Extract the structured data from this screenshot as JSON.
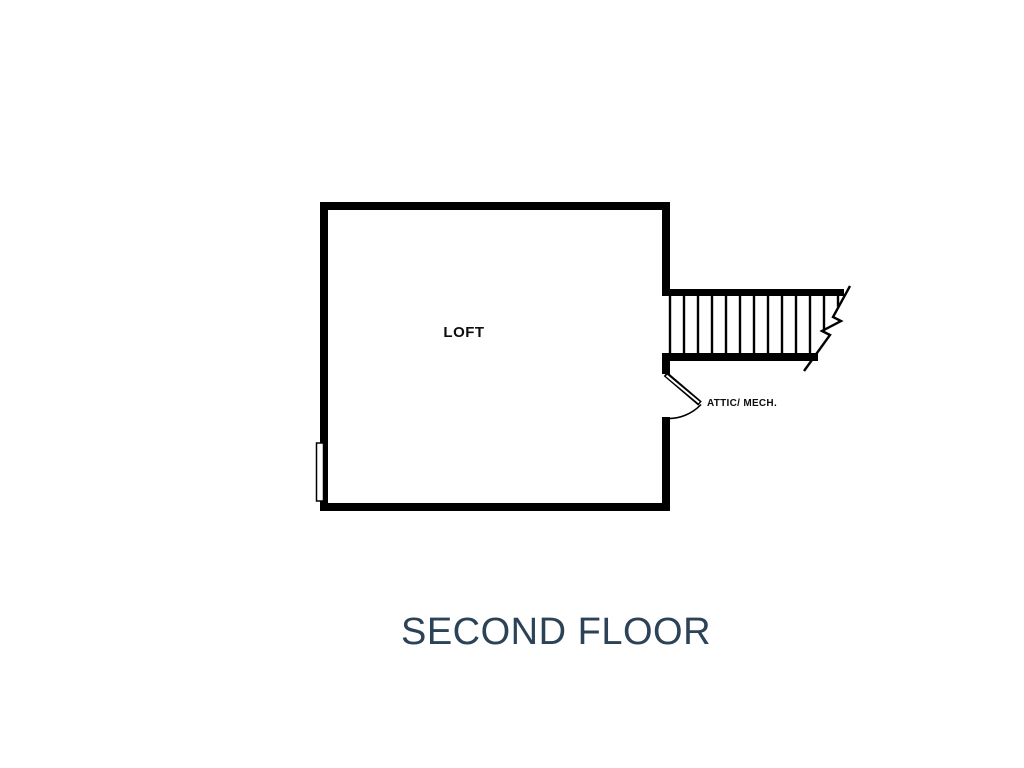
{
  "plan": {
    "title": "SECOND FLOOR",
    "rooms": [
      {
        "name": "LOFT"
      },
      {
        "name": "ATTIC/ MECH."
      }
    ],
    "stairs": {
      "tread_count": 13
    },
    "colors": {
      "wall": "#000000",
      "line": "#000000",
      "background": "#ffffff",
      "title_text": "#2b4257",
      "label_text": "#0d0d0d"
    }
  }
}
